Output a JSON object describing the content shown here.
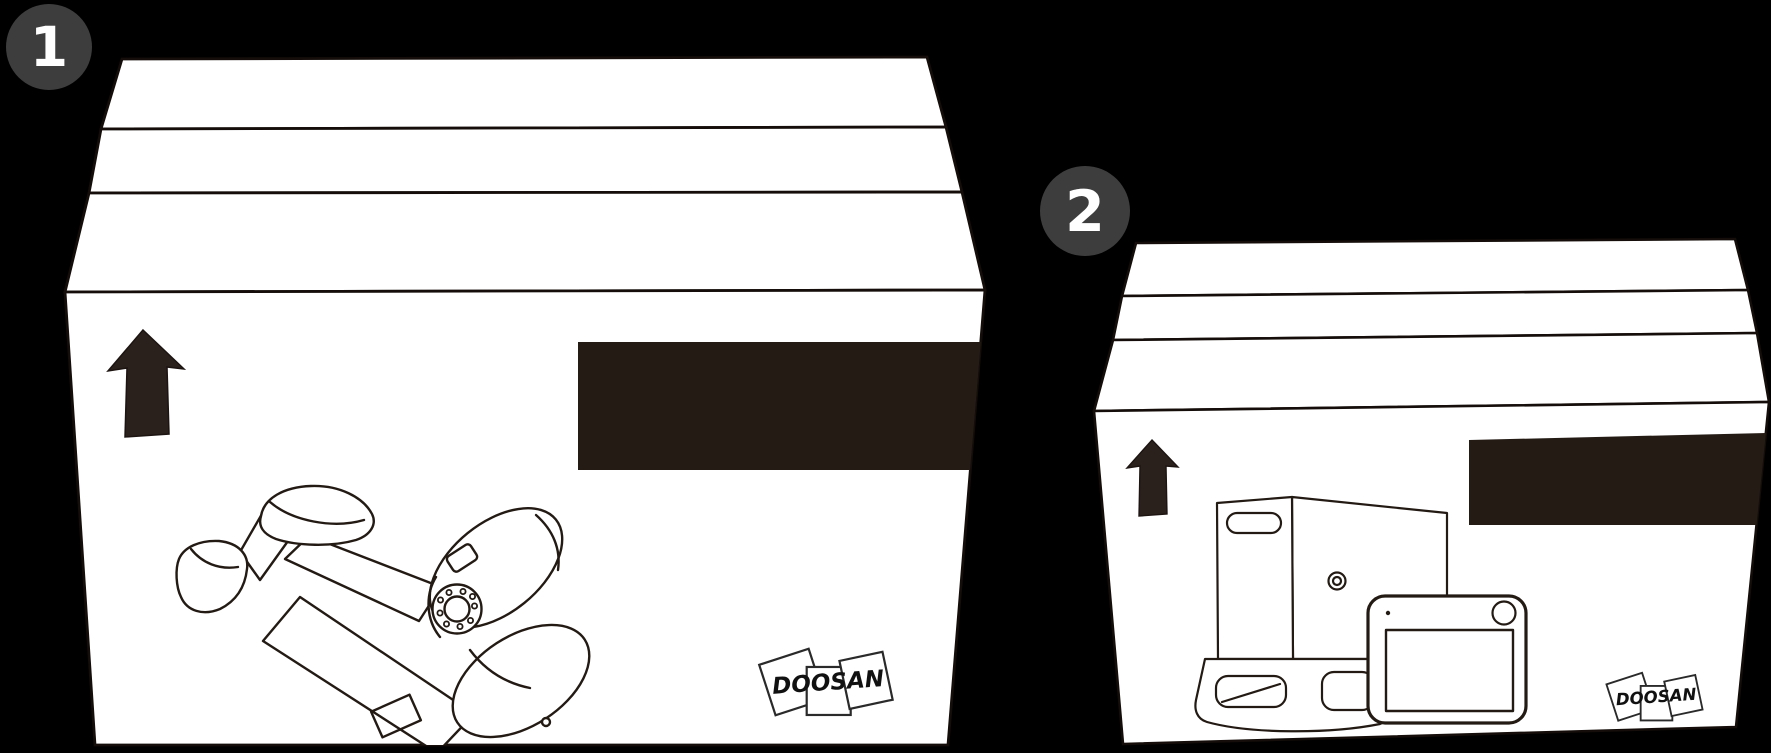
{
  "scene": {
    "badges": [
      {
        "label": "1"
      },
      {
        "label": "2"
      }
    ],
    "boxes": [
      {
        "logo_text": "DOOSAN"
      },
      {
        "logo_text": "DOOSAN"
      }
    ],
    "icons": {
      "box1_arrow": "up-arrow",
      "box2_arrow": "up-arrow"
    },
    "colors": {
      "background": "#000000",
      "box_fill": "#ffffff",
      "line_ink": "#231a14",
      "label_dark": "#241b15",
      "arrow_dark": "#2b211c",
      "badge_bg": "#3d3d3d",
      "badge_text": "#ffffff",
      "logo_ink": "#111111"
    }
  }
}
